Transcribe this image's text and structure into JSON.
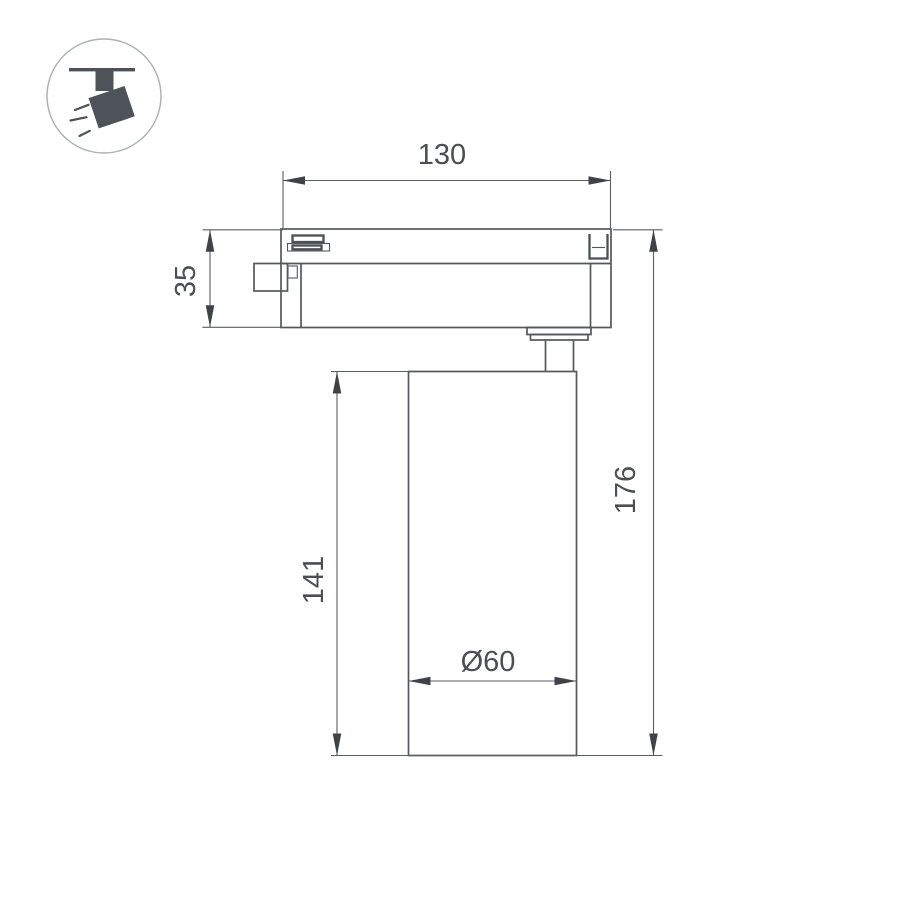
{
  "page": {
    "background": "#ffffff",
    "type": "technical-dimension-drawing",
    "subject": "track-mounted LED spotlight, side elevation"
  },
  "icon_badge": {
    "name": "track-spotlight-icon",
    "shape": "circle-badge"
  },
  "dimensions": {
    "track_width": {
      "label": "130",
      "value": 130,
      "orientation": "horizontal"
    },
    "adapter_height": {
      "label": "35",
      "value": 35,
      "orientation": "vertical"
    },
    "body_height": {
      "label": "141",
      "value": 141,
      "orientation": "vertical"
    },
    "total_height": {
      "label": "176",
      "value": 176,
      "orientation": "vertical"
    },
    "body_diameter": {
      "label": "Ø60",
      "value": 60,
      "orientation": "horizontal"
    }
  },
  "colors": {
    "outline": "#54585c",
    "dimension_line": "#5b5e61",
    "arrow": "#3f4347",
    "text": "#4b4f54",
    "icon": "#4d5358",
    "icon_circle": "#acb0b3"
  }
}
